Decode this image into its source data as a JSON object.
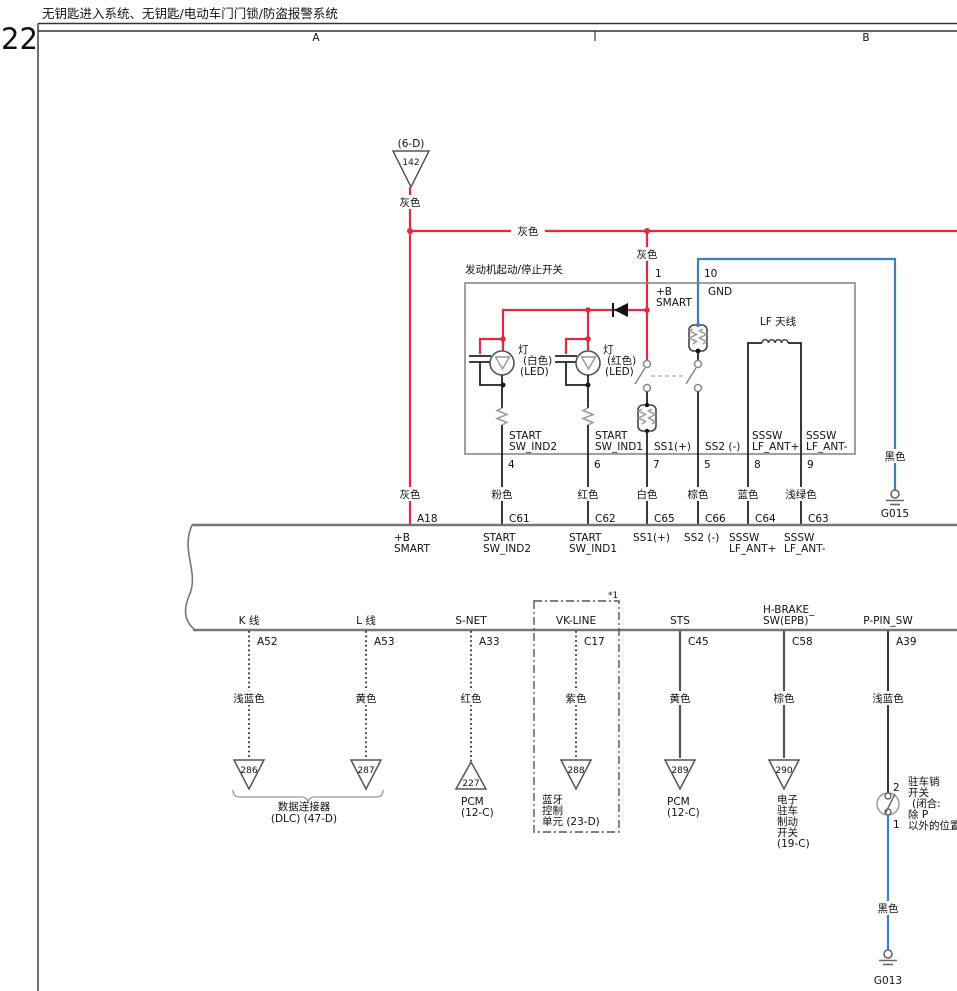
{
  "page": {
    "number": "22",
    "title": "无钥匙进入系统、无钥匙/电动车门门锁/防盗报警系统",
    "col_a": "A",
    "col_b": "B"
  },
  "feed": {
    "ref": "(6-D)",
    "num": "142",
    "wire": "灰色",
    "rail": "灰色",
    "branch_wire": "灰色"
  },
  "box": {
    "title": "发动机起动/停止开关",
    "pin1": "1",
    "pin1_l1": "+B",
    "pin1_l2": "SMART",
    "pin10": "10",
    "pin10_name": "GND",
    "lampw": {
      "l1": "灯",
      "l2": "(白色)",
      "l3": "(LED)"
    },
    "lampr": {
      "l1": "灯",
      "l2": "(红色)",
      "l3": "(LED)"
    },
    "lf": "LF 天线",
    "t_ind2_1": "START",
    "t_ind2_2": "SW_IND2",
    "t_ind1_1": "START",
    "t_ind1_2": "SW_IND1",
    "t_ss1": "SS1(+)",
    "t_ss2": "SS2 (-)",
    "t_antp_1": "SSSW",
    "t_antp_2": "LF_ANT+",
    "t_antm_1": "SSSW",
    "t_antm_2": "LF_ANT-"
  },
  "top_cols": [
    {
      "pin": "",
      "color": "灰色",
      "conn": "A18",
      "n1": "+B",
      "n2": "SMART"
    },
    {
      "pin": "4",
      "color": "粉色",
      "conn": "C61",
      "n1": "START",
      "n2": "SW_IND2"
    },
    {
      "pin": "6",
      "color": "红色",
      "conn": "C62",
      "n1": "START",
      "n2": "SW_IND1"
    },
    {
      "pin": "7",
      "color": "白色",
      "conn": "C65",
      "n1": "SS1(+)",
      "n2": ""
    },
    {
      "pin": "5",
      "color": "棕色",
      "conn": "C66",
      "n1": "SS2 (-)",
      "n2": ""
    },
    {
      "pin": "8",
      "color": "蓝色",
      "conn": "C64",
      "n1": "SSSW",
      "n2": "LF_ANT+"
    },
    {
      "pin": "9",
      "color": "浅绿色",
      "conn": "C63",
      "n1": "SSSW",
      "n2": "LF_ANT-"
    }
  ],
  "g015": {
    "wire": "黑色",
    "name": "G015"
  },
  "bot_cols": [
    {
      "n1": "K 线",
      "n2": "",
      "conn": "A52",
      "color": "浅蓝色",
      "tri": "286"
    },
    {
      "n1": "L 线",
      "n2": "",
      "conn": "A53",
      "color": "黄色",
      "tri": "287"
    },
    {
      "n1": "S-NET",
      "n2": "",
      "conn": "A33",
      "color": "红色",
      "tri": "227",
      "d1": "PCM",
      "d2": "(12-C)"
    },
    {
      "n1": "VK-LINE",
      "n2": "",
      "conn": "C17",
      "color": "紫色",
      "tri": "288",
      "d1": "蓝牙",
      "d2": "控制",
      "d3": "单元 (23-D)",
      "note": "*1"
    },
    {
      "n1": "STS",
      "n2": "",
      "conn": "C45",
      "color": "黄色",
      "tri": "289",
      "d1": "PCM",
      "d2": "(12-C)"
    },
    {
      "n1": "H-BRAKE_",
      "n2": "SW(EPB)",
      "conn": "C58",
      "color": "棕色",
      "tri": "290",
      "d1": "电子",
      "d2": "驻车",
      "d3": "制动",
      "d4": "开关",
      "d5": "(19-C)"
    },
    {
      "n1": "P-PIN_SW",
      "n2": "",
      "conn": "A39",
      "color": "浅蓝色"
    }
  ],
  "dlc": {
    "l1": "数据连接器",
    "l2": "(DLC) (47-D)"
  },
  "ppin": {
    "p2": "2",
    "p1": "1",
    "l1": "驻车销",
    "l2": "开关",
    "l3": "(闭合:",
    "l4": "除 P",
    "l5": "以外的位置)",
    "wire": "黑色",
    "gnd": "G013"
  }
}
